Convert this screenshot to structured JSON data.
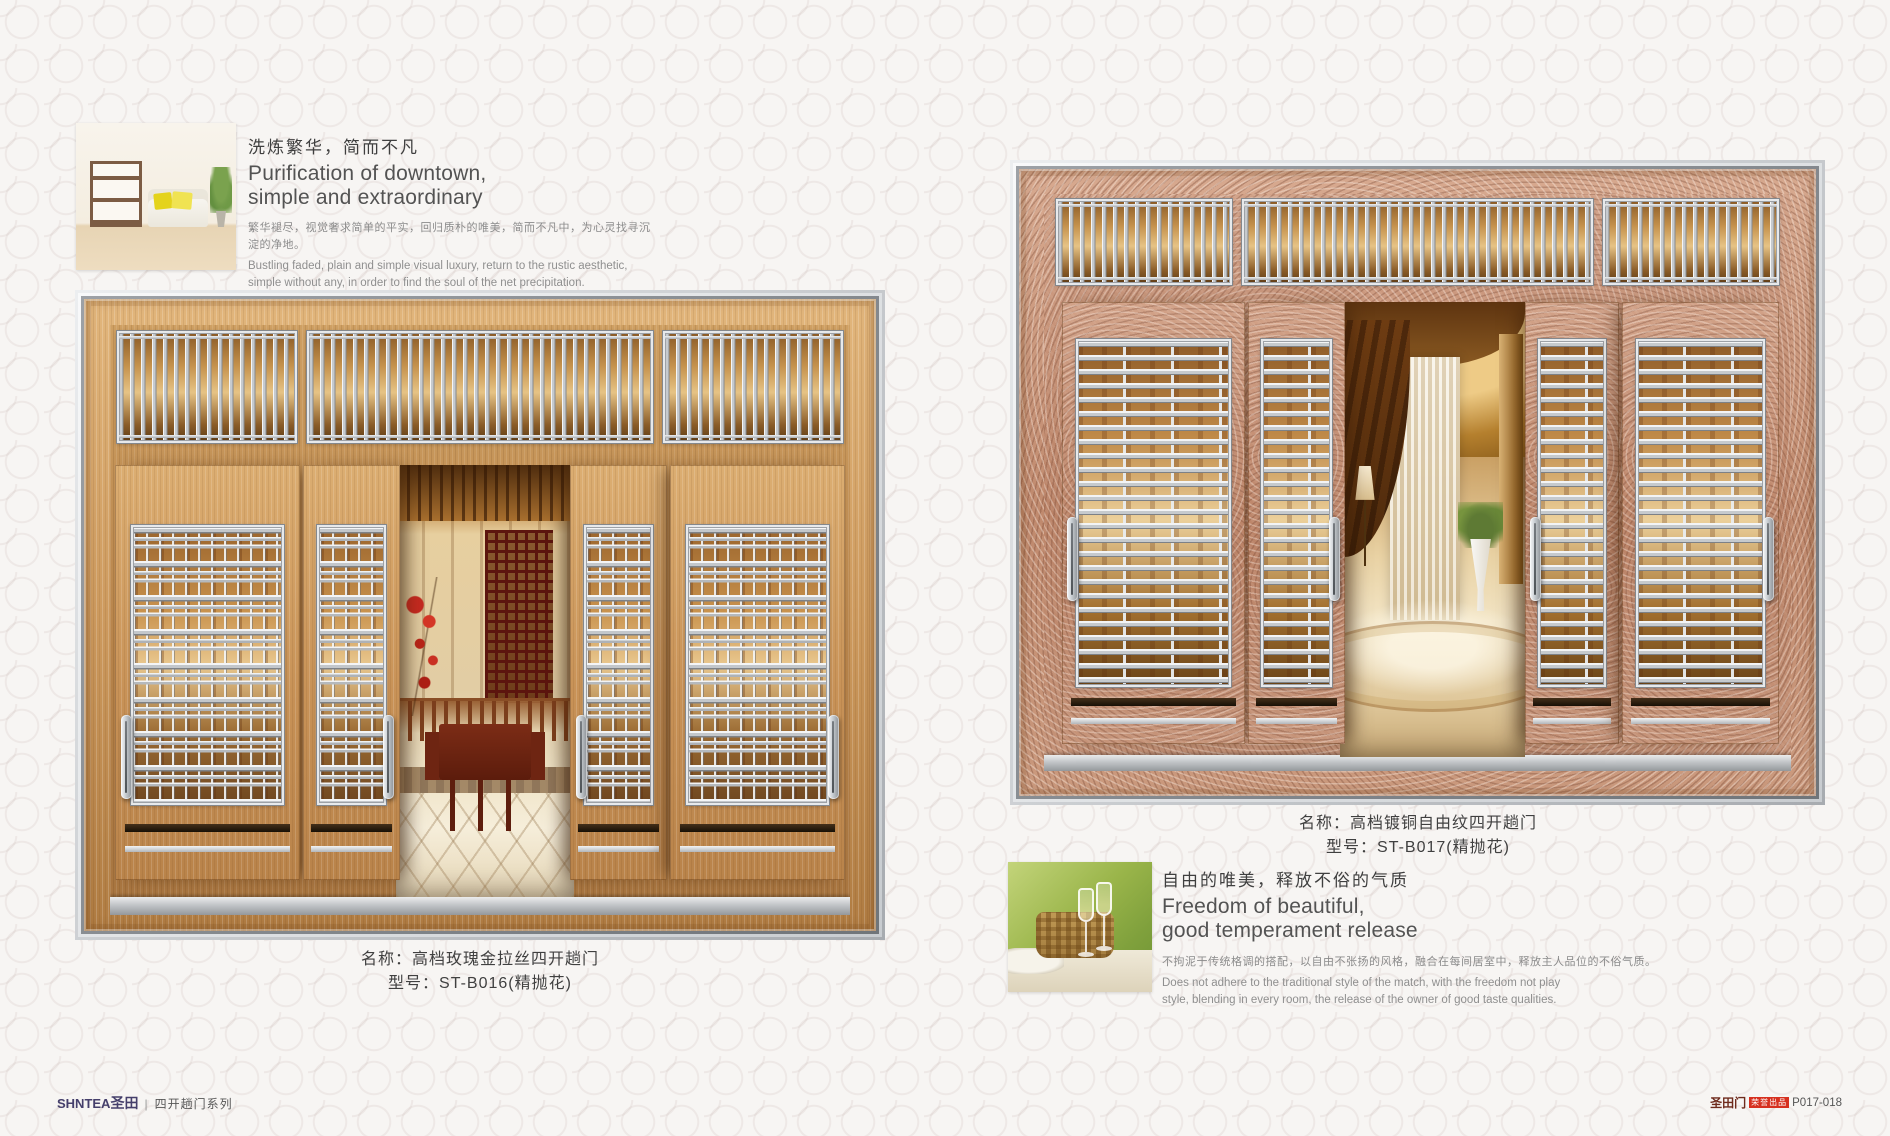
{
  "left_section": {
    "intro": {
      "title_cn": "洗炼繁华，简而不凡",
      "title_en": [
        "Purification of downtown,",
        "simple and extraordinary"
      ],
      "para_cn": "繁华褪尽，视觉奢求简单的平实，回归质朴的唯美，简而不凡中，为心灵找寻沉淀的净地。",
      "para_en": [
        "Bustling faded, plain and simple visual luxury, return to the rustic aesthetic,",
        "simple without any, in order to find the soul of the net precipitation."
      ]
    },
    "door": {
      "name": "名称：高档玫瑰金拉丝四开趟门",
      "model": "型号：ST-B016(精抛花)"
    }
  },
  "right_section": {
    "door": {
      "name": "名称：高档镀铜自由纹四开趟门",
      "model": "型号：ST-B017(精抛花)"
    },
    "feature": {
      "title_cn": "自由的唯美，释放不俗的气质",
      "title_en": [
        "Freedom of beautiful,",
        "good temperament release"
      ],
      "para_cn": "不拘泥于传统格调的搭配，以自由不张扬的风格，融合在每间居室中，释放主人品位的不俗气质。",
      "para_en": [
        "Does not adhere to the traditional style of the match, with the freedom not play",
        "style, blending in every room, the release of the owner of good taste qualities."
      ]
    }
  },
  "footer": {
    "brand": "SHNTEA",
    "brand_cn": "圣田",
    "series": "四开趟门系列",
    "brand_right": "圣田门",
    "badge": "荣誉出品",
    "page_no": "P017-018"
  },
  "colors": {
    "rose_gold_wood": "#c89257",
    "copper": "#bb8367",
    "silver": "#c6cace",
    "badge_red": "#d6301f",
    "logo_navy": "#453f6b",
    "page_bg": "#f7f5f3"
  }
}
